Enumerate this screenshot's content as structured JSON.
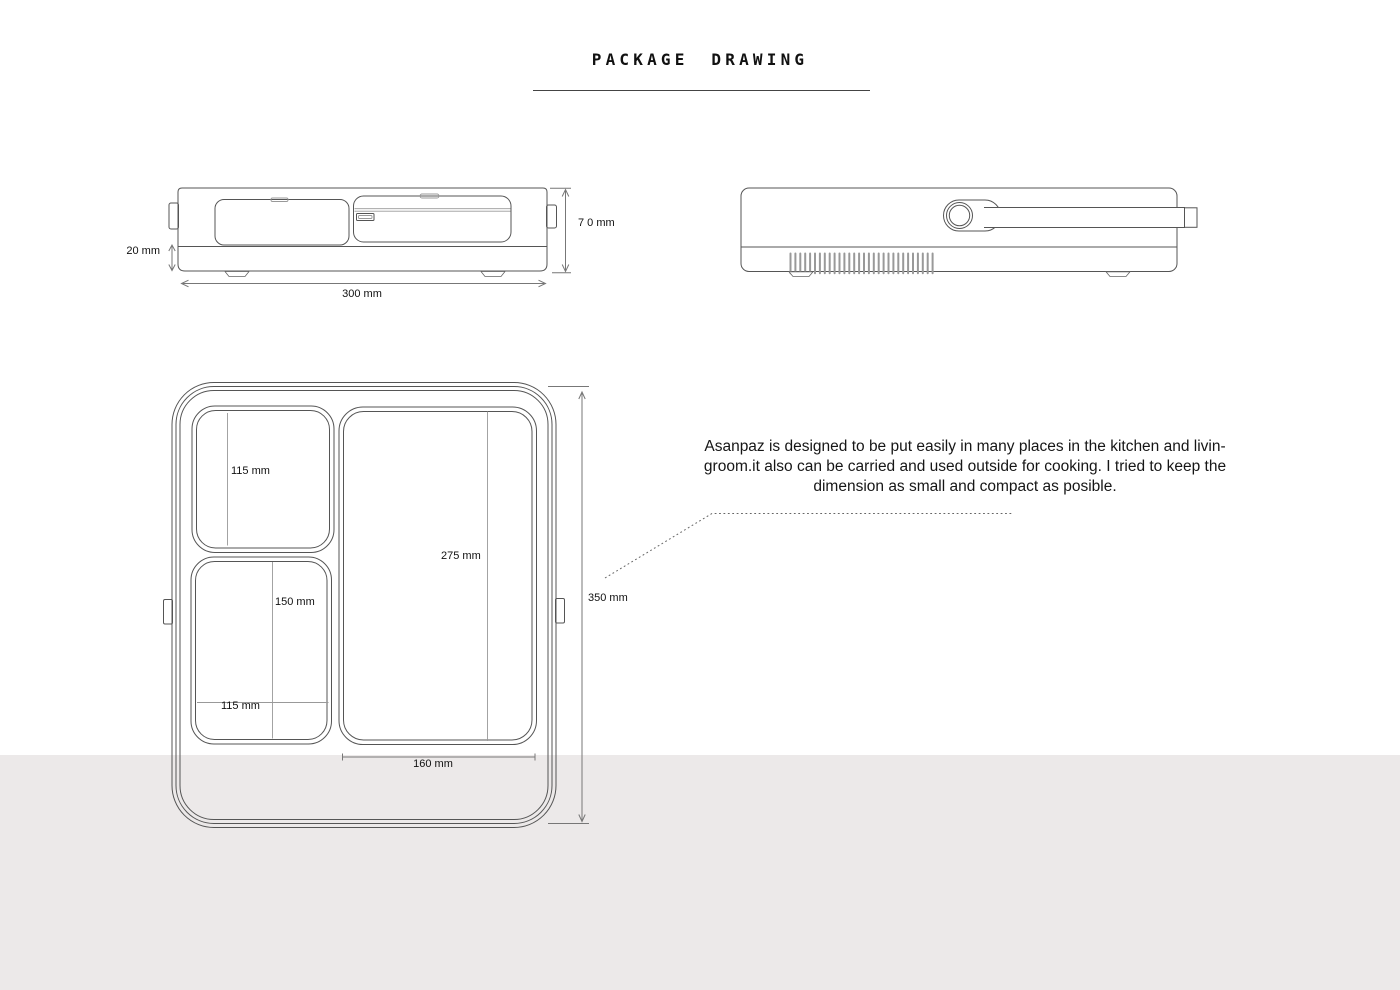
{
  "page": {
    "title": "PACKAGE DRAWING",
    "background_color": "#ffffff",
    "footer_band_color": "#ece9e9",
    "line_color": "#555555",
    "dimension_line_color": "#777777"
  },
  "annotation": {
    "lines": [
      "Asanpaz is designed to be put easily in many places in the kitchen and livin-",
      "groom.it also can be carried and used outside for cooking. I tried to keep the",
      "dimension as small and compact as posible."
    ]
  },
  "front_view": {
    "height_label": "7 0 mm",
    "base_height_label": "20 mm",
    "width_label": "300 mm"
  },
  "top_view": {
    "small_compartment_height_label": "115 mm",
    "lower_compartment_height_label": "150 mm",
    "lower_compartment_width_label": "115 mm",
    "main_compartment_height_label": "275 mm",
    "overall_height_label": "350 mm",
    "main_compartment_width_label": "160 mm"
  }
}
